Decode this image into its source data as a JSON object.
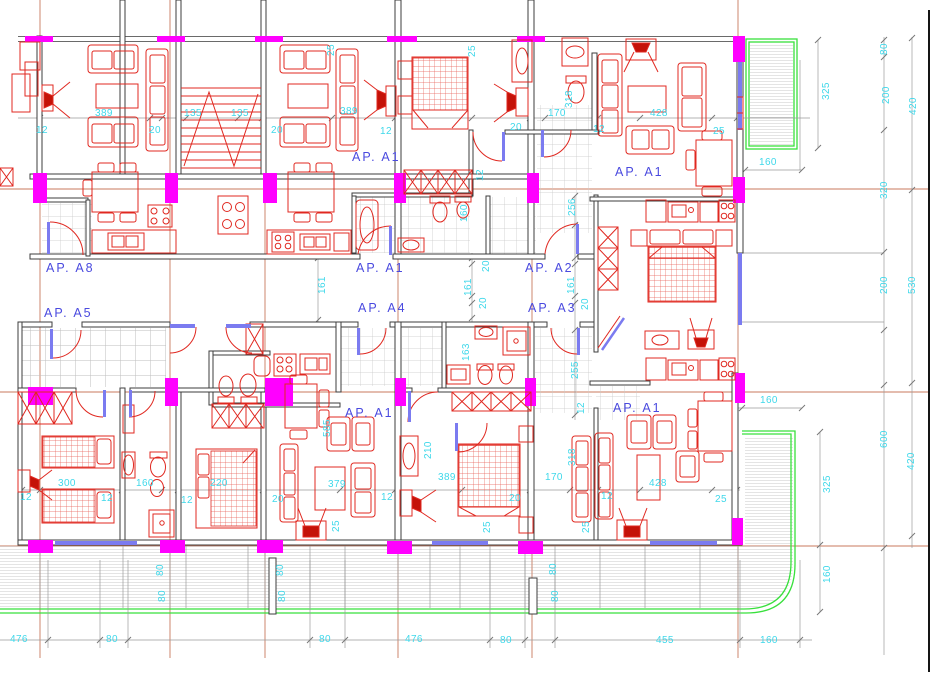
{
  "drawing_type": "apartment-building-floor-plan",
  "colors": {
    "furniture": "#e02820",
    "walls": "#3c3c3c",
    "columns": "#ff00ff",
    "dimension_text": "#3fd8ea",
    "apartment_labels": "#4a4adf",
    "openings_windows": "#7b7bf0",
    "grid_axes": "#c97a5e",
    "balcony_outline": "#38e03c",
    "hatch": "#9b9b9b"
  },
  "apartments": [
    {
      "label": "AP. A8"
    },
    {
      "label": "AP. A5"
    },
    {
      "label": "AP. A1"
    },
    {
      "label": "AP. A1"
    },
    {
      "label": "AP. A1"
    },
    {
      "label": "AP. A2"
    },
    {
      "label": "AP. A4"
    },
    {
      "label": "AP. A3"
    },
    {
      "label": "AP. A1"
    },
    {
      "label": "AP. A1"
    }
  ],
  "dims": [
    "12",
    "389",
    "20",
    "135",
    "135",
    "20",
    "25",
    "389",
    "12",
    "25",
    "20",
    "12",
    "170",
    "318",
    "428",
    "25",
    "160",
    "325",
    "80",
    "200",
    "420",
    "320",
    "200",
    "530",
    "160",
    "256",
    "12",
    "161",
    "20",
    "161",
    "20",
    "161",
    "20",
    "163",
    "255",
    "12",
    "300",
    "12",
    "160",
    "12",
    "220",
    "12",
    "20",
    "585",
    "379",
    "25",
    "12",
    "210",
    "389",
    "25",
    "20",
    "170",
    "318",
    "25",
    "12",
    "428",
    "25",
    "160",
    "600",
    "420",
    "325",
    "160",
    "80",
    "80",
    "80",
    "80",
    "80",
    "80",
    "476",
    "80",
    "80",
    "476",
    "80",
    "455",
    "160"
  ]
}
